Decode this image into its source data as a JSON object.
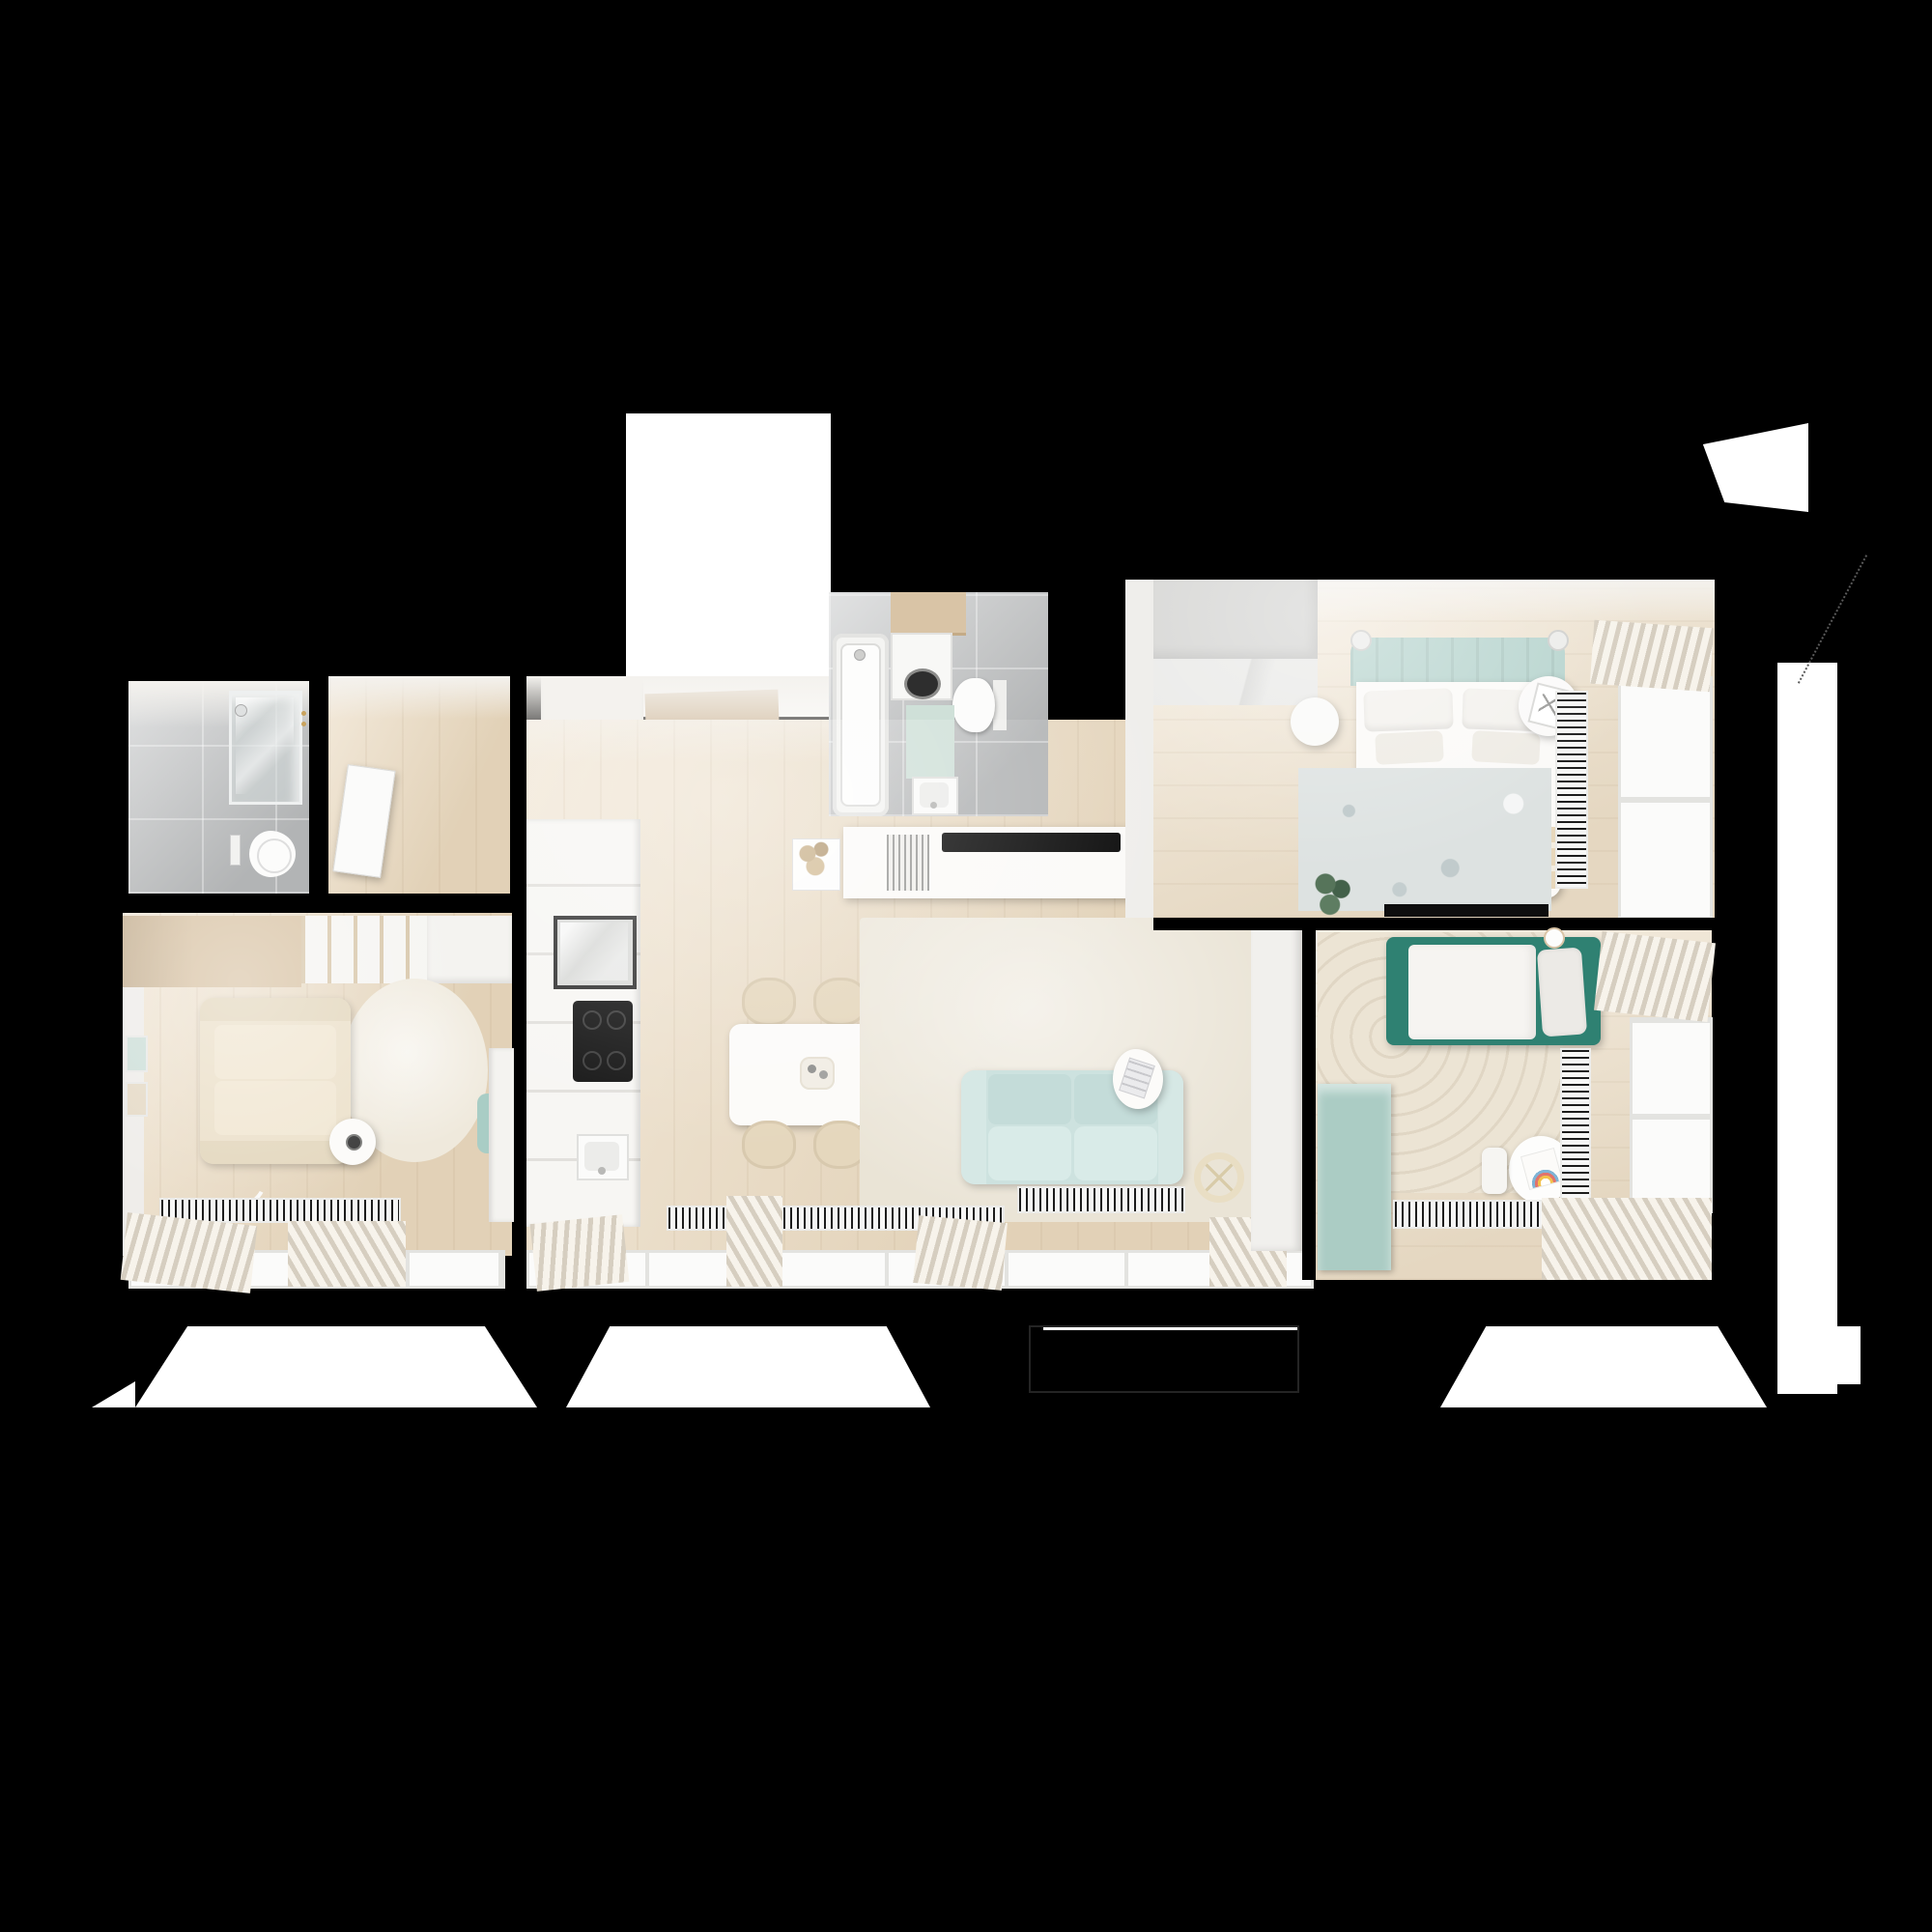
{
  "title": "apartment-floor-plan-3d-top-view",
  "palette": {
    "background": "#000000",
    "exterior_white": "#ffffff",
    "wood_floor": "#e9d8bd",
    "wood_accent": "#d8c3a4",
    "tile_grey": "#bdbfc0",
    "teal_dark": "#2f8172",
    "teal_light": "#abccc4",
    "sofa_blue": "#cde2df",
    "headboard_teal": "#b7d4ce",
    "rug_cream": "#eae4d6",
    "sofa_beige": "#ece1cb",
    "doormat_brown": "#c3ad97",
    "radiator_dark": "#1c1c1c"
  },
  "rooms": [
    {
      "name": "bathroom-1",
      "items": [
        "shower-enclosure",
        "shower-head",
        "toilet",
        "flush-plate",
        "towel-hooks",
        "open-door"
      ]
    },
    {
      "name": "hallway",
      "items": [
        "wood-floor",
        "bathroom-door"
      ]
    },
    {
      "name": "entry",
      "items": [
        "white-alcove",
        "open-wood-door",
        "doormat",
        "entry-closet"
      ]
    },
    {
      "name": "bathroom-2",
      "items": [
        "bathtub",
        "washing-machine",
        "wood-shelf",
        "toilet",
        "bath-mat",
        "sink"
      ]
    },
    {
      "name": "kitchen-living-room",
      "items": [
        "kitchen-cabinets",
        "glass-cabinet",
        "cooktop",
        "kitchen-sink",
        "dining-table",
        "dining-chairs-x4",
        "centerpiece",
        "area-rug",
        "sofa-blue",
        "side-table",
        "magazine",
        "floor-lamp-ring",
        "tv-console",
        "tv",
        "speaker-grille",
        "plant-pot",
        "radiator-x2",
        "windows",
        "curtains"
      ]
    },
    {
      "name": "office-room",
      "items": [
        "wardrobe-shelf",
        "sofa-beige",
        "round-rug",
        "side-table",
        "cup",
        "pouf-teal",
        "desk",
        "wall-frames-x2",
        "radiator",
        "window",
        "curtains"
      ]
    },
    {
      "name": "main-bedroom",
      "items": [
        "wardrobe-grey",
        "double-bed",
        "headboard-teal",
        "pillows-x4",
        "blanket-beige",
        "nightstand-x2",
        "wall-lamp-x2",
        "picture-frame",
        "rug-blue-grey",
        "plant",
        "wall-tv",
        "radiator",
        "window",
        "curtains"
      ]
    },
    {
      "name": "kids-room",
      "items": [
        "single-bed-teal",
        "pillow",
        "cup",
        "arc-pattern-rug",
        "bench-teal",
        "kids-table",
        "rainbow-drawing",
        "stool",
        "radiator-x2",
        "window",
        "curtains"
      ]
    }
  ],
  "exterior": {
    "shapes": [
      "entrance-alcove",
      "roof-wedge",
      "right-white-strip",
      "balcony-trapezoid-x3",
      "parapet-outline",
      "edge-sliver"
    ]
  }
}
